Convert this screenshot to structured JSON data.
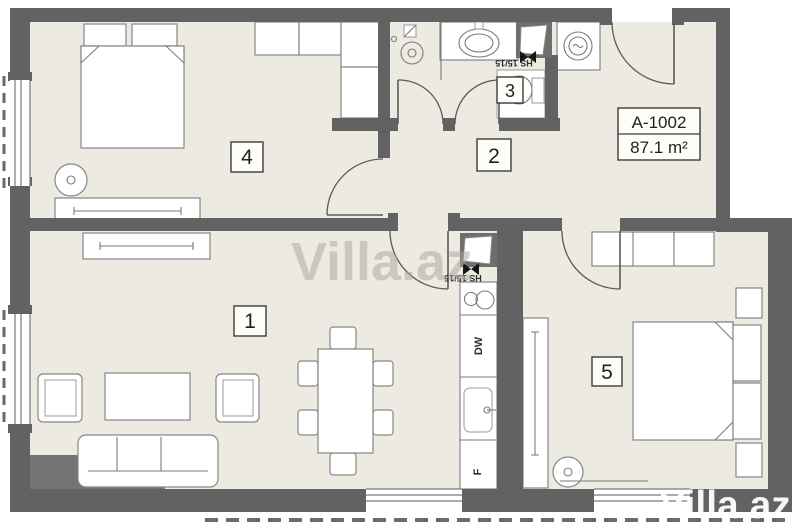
{
  "unit": {
    "code": "A-1002",
    "area": "87.1 m²"
  },
  "room_labels": [
    "1",
    "2",
    "3",
    "4",
    "5"
  ],
  "appliance_labels": {
    "dishwasher": "DW",
    "fridge": "F"
  },
  "vent_labels": {
    "bath": "HS 15/15",
    "kitchen": "HS 15/15"
  },
  "watermarks": {
    "center": "Villa.az",
    "corner": "Villa.az"
  },
  "colors": {
    "wall": "#626262",
    "floor": "#edeae1",
    "watermark_center": "#a9a69c",
    "watermark_corner": "#ffffff"
  }
}
